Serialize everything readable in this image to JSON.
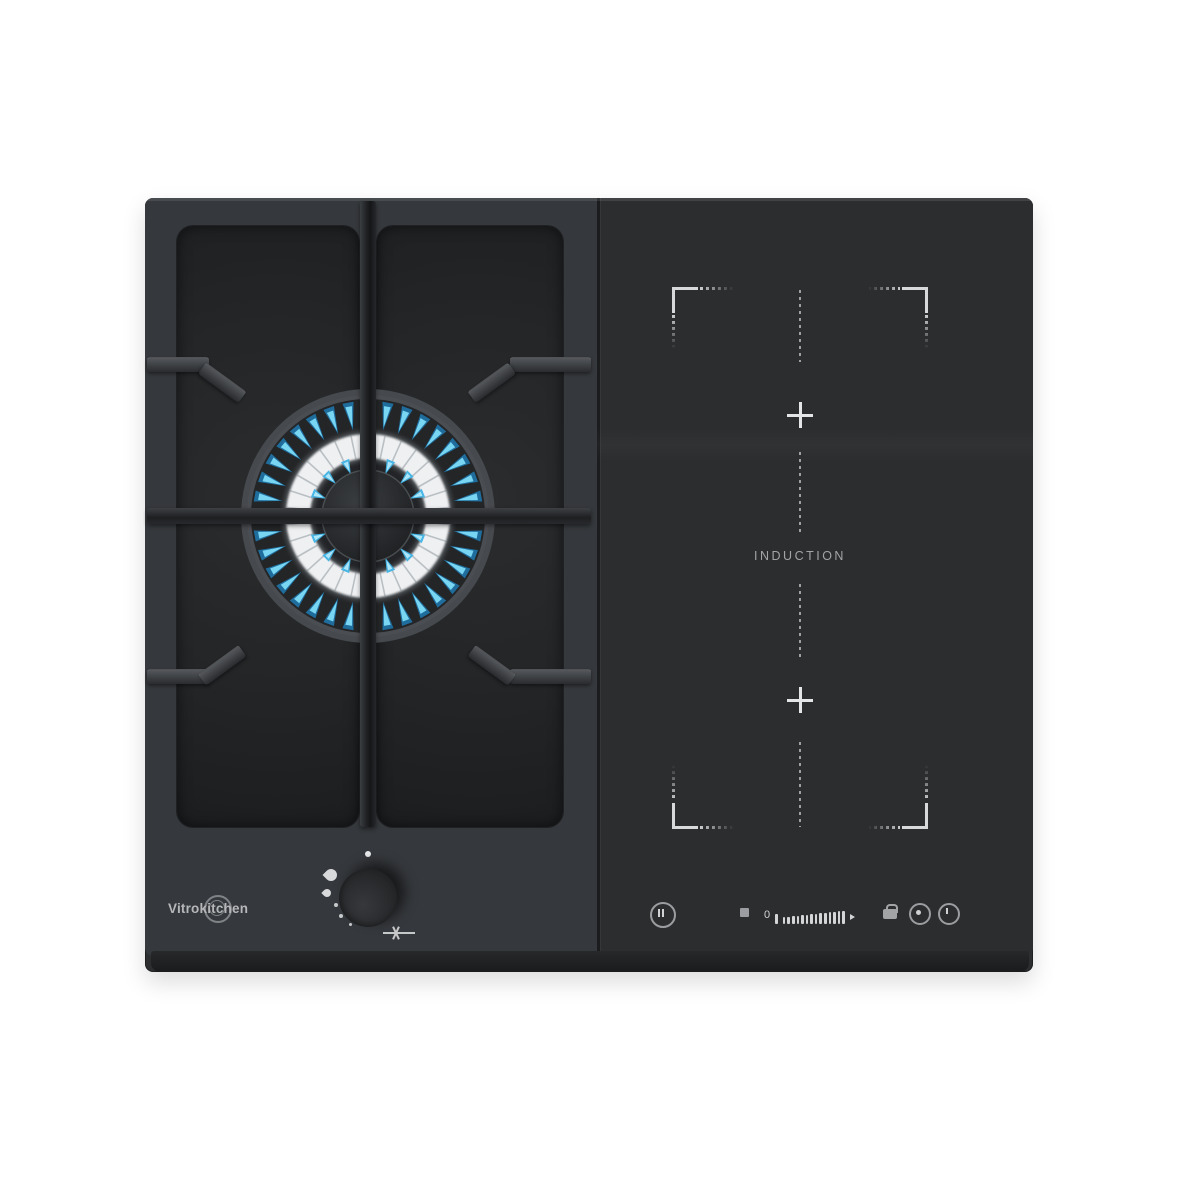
{
  "product": {
    "brand": "Vitrokitchen",
    "induction_label": "INDUCTION"
  },
  "burner": {
    "outer_flame_count": 36,
    "inner_flame_count": 16,
    "port_tick_count": 30,
    "flame_glow_color": "#1f86c5",
    "flame_core_color": "#7edcf8",
    "inner_flame_color": "#3fb3e6",
    "inner_flame_core_color": "#b9ecfb",
    "ring_glow_color": "#eef0f2"
  },
  "gas_controls": {
    "knob_icons": [
      "off-dot",
      "high-flame-icon",
      "low-flame-icon",
      "ignition-spark-icon"
    ]
  },
  "induction_controls": {
    "slider": {
      "min_label": "0",
      "bar_count": 14
    },
    "icons": [
      "pause-icon",
      "stop-square-icon",
      "power-slider",
      "lock-icon",
      "timer-icon",
      "power-icon"
    ]
  },
  "zones": {
    "flex_zone_plus_marks": 2,
    "marker_color": "#d8d9da"
  },
  "colors": {
    "body": "#2c2e30",
    "glass": "#2b2d2f",
    "frame": "#35383c",
    "tray": "#232527",
    "accent_flame": "#45b9ea"
  }
}
